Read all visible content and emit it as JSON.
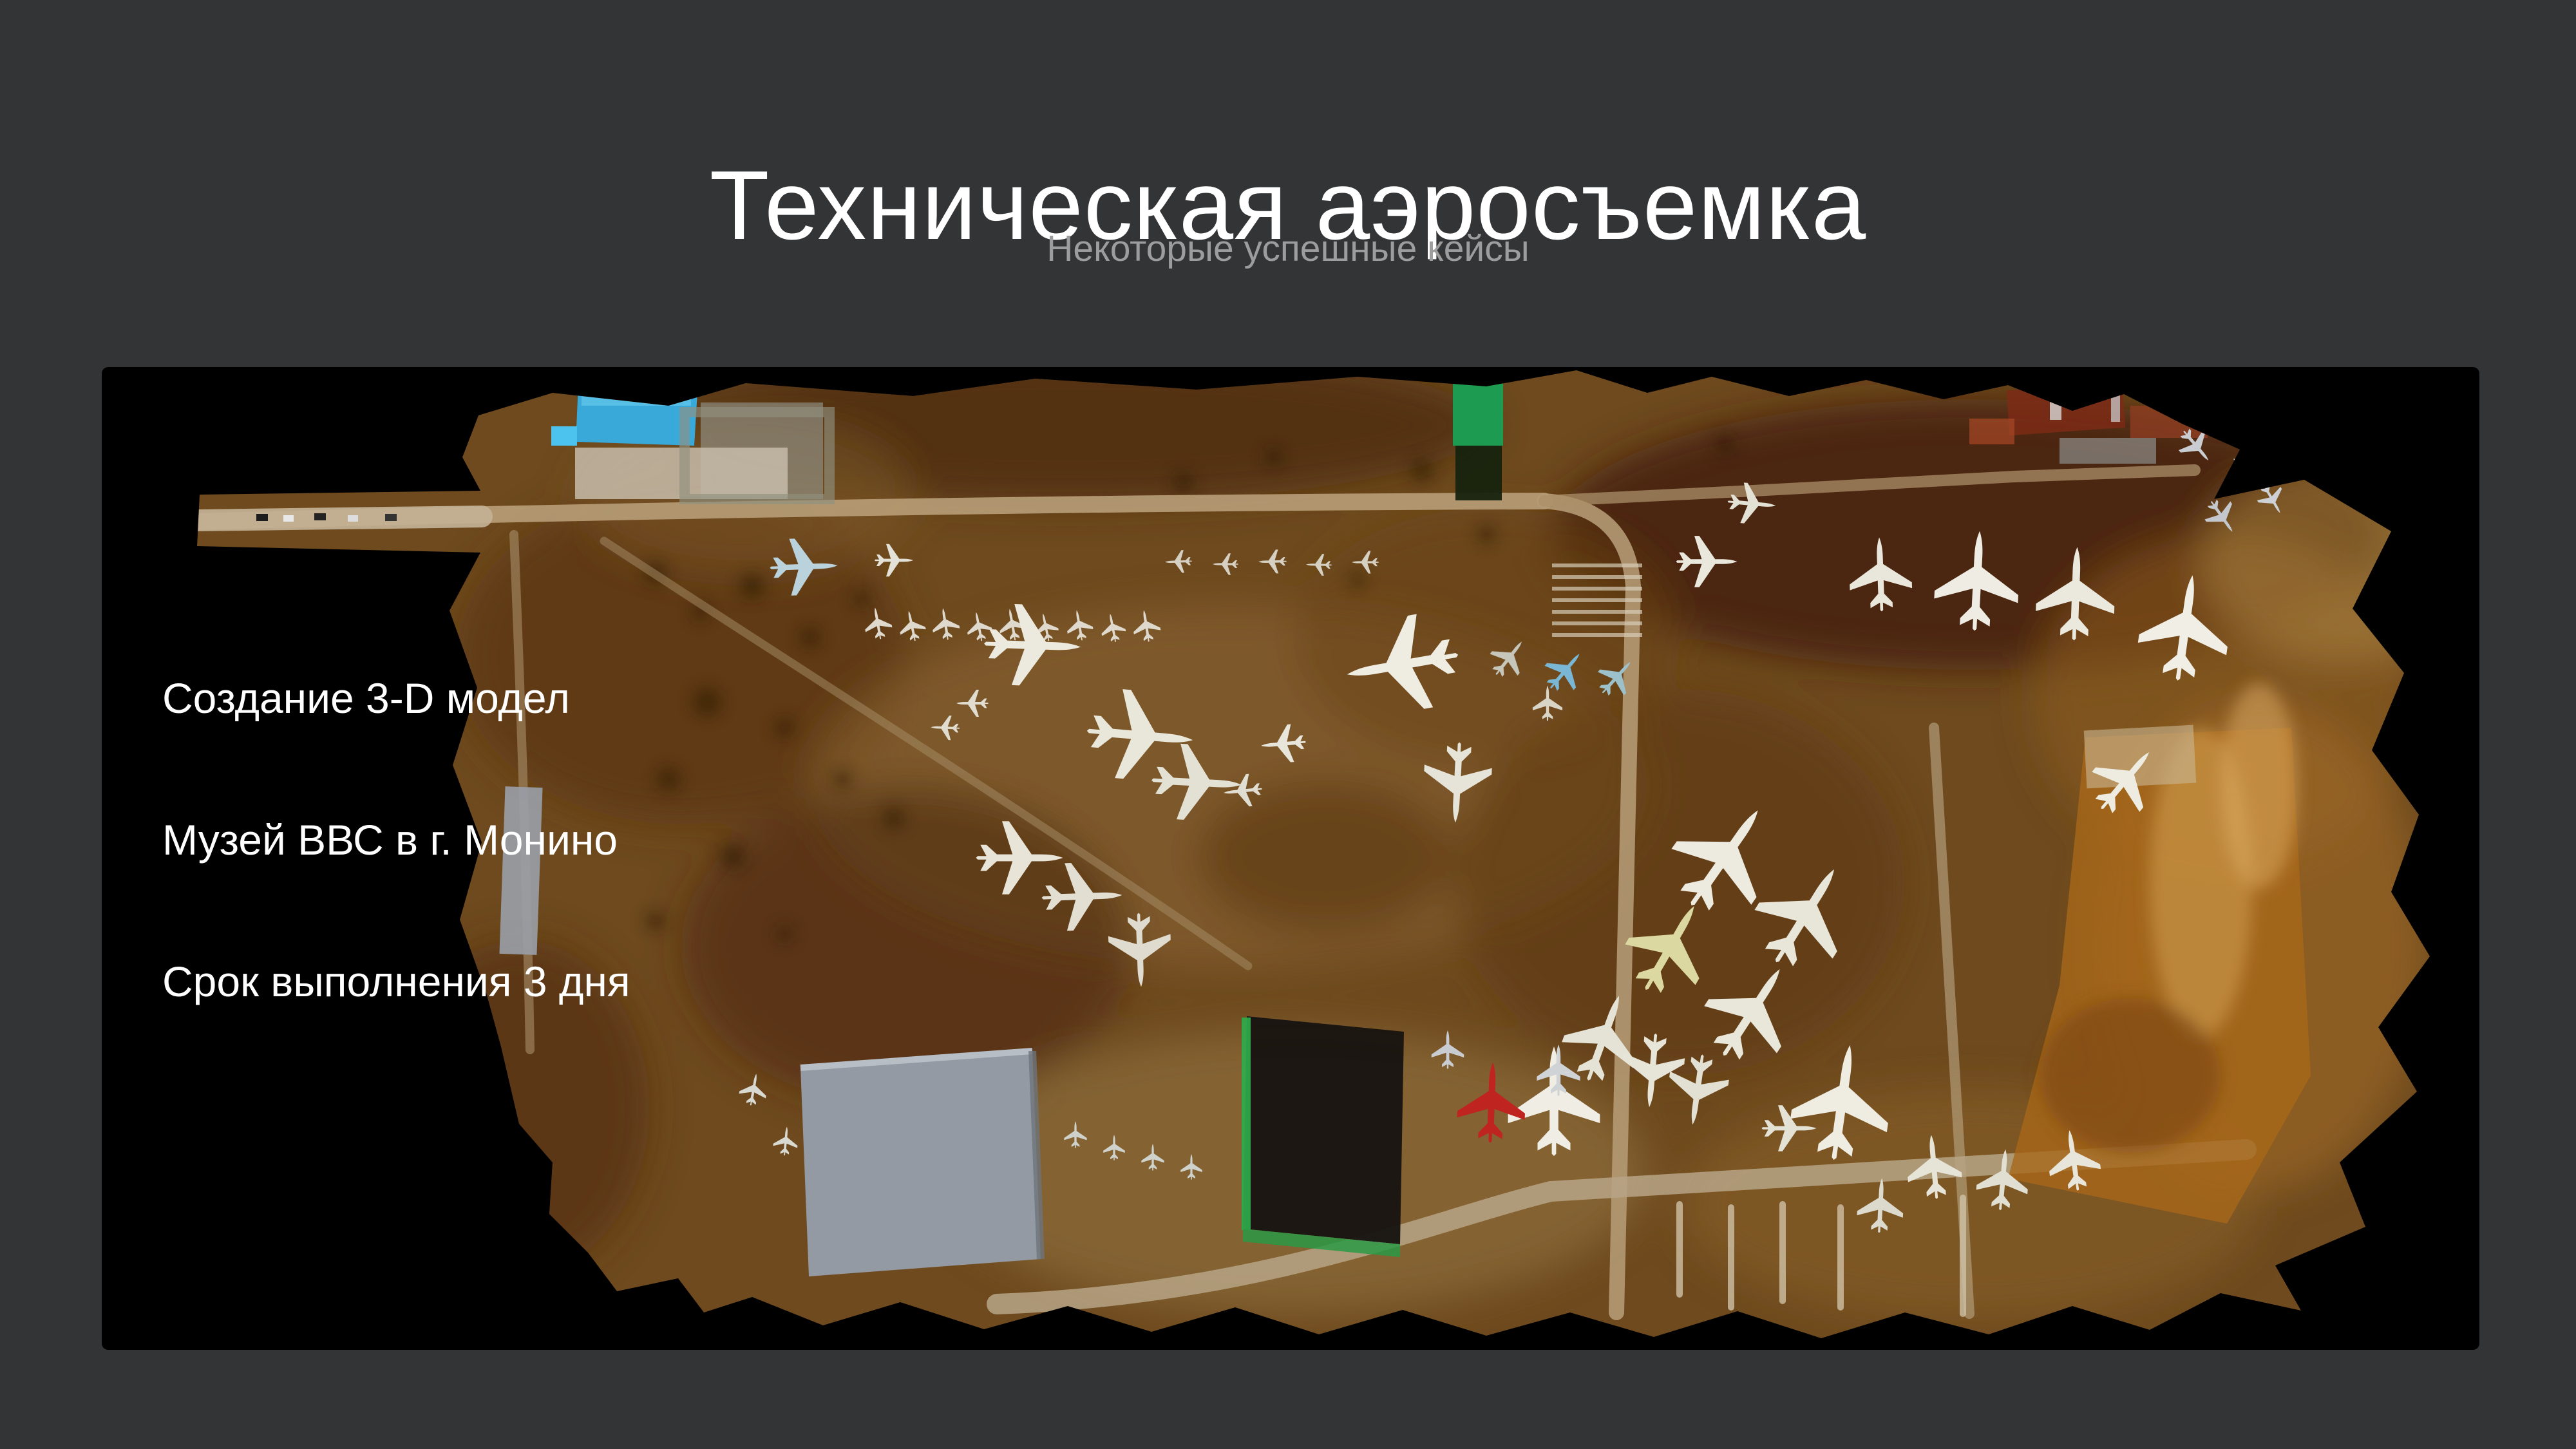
{
  "slide": {
    "title": "Техническая аэросъемка",
    "subtitle": "Некоторые успешные кейсы",
    "captions": [
      "Создание 3-D модел",
      "Музей ВВС в г. Монино",
      "Срок выполнения 3 дня"
    ]
  },
  "colors": {
    "slide_background": "#333436",
    "title_text": "#ffffff",
    "subtitle_text": "#9d9d9d",
    "caption_text": "#ffffff",
    "photo_background": "#000000",
    "terrain_brown": "#6e4a1e",
    "road_tan": "#b49a74",
    "hangar_gray": "#949aa3",
    "roof_blue": "#38a9d9",
    "roof_green": "#1d9b50",
    "dig_orange": "#a8681a",
    "aircraft_white": "#eceadf",
    "aircraft_blue": "#79b7d5",
    "aircraft_red": "#bf2420"
  }
}
